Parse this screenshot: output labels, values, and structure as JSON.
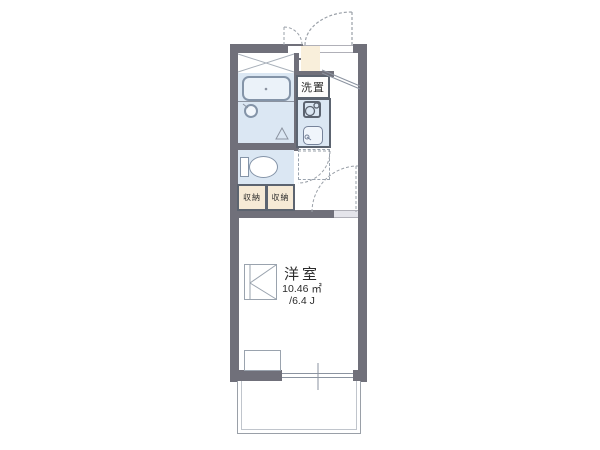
{
  "plan": {
    "title": "apartment-floor-plan",
    "room": {
      "name": "洋室",
      "area_m2": "10.46 ㎡",
      "area_jo": "/6.4 J"
    },
    "washer": {
      "label": "洗置"
    },
    "closets": [
      {
        "label": "収納"
      },
      {
        "label": "収納"
      }
    ],
    "fixtures": [
      "bathtub",
      "wash-basin",
      "toilet",
      "stove",
      "kitchen-sink",
      "refrigerator-space",
      "entrance-door",
      "room-door",
      "toilet-door",
      "meter-box-door",
      "balcony",
      "window"
    ],
    "colors": {
      "wall": "#70707a",
      "water_floor": "#dbe7f3",
      "closet_fill": "#f6ead6",
      "entrance_fill": "#f9efdb",
      "fixture_border": "#5c6470"
    }
  }
}
